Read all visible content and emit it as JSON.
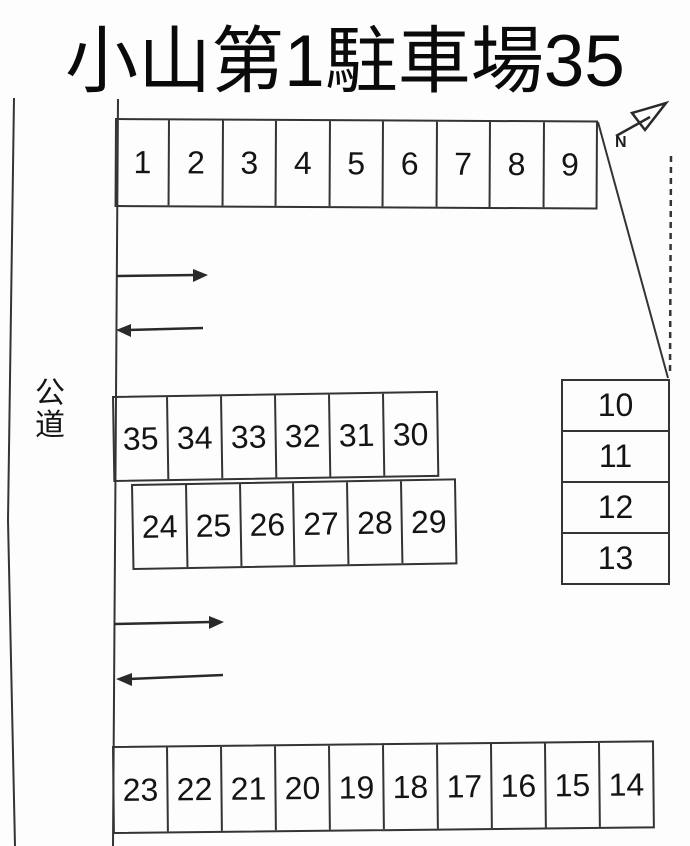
{
  "title": "小山第1駐車場35",
  "road_label": "公道",
  "compass": {
    "label": "N"
  },
  "spaces": {
    "top": [
      "1",
      "2",
      "3",
      "4",
      "5",
      "6",
      "7",
      "8",
      "9"
    ],
    "right_column": [
      "10",
      "11",
      "12",
      "13"
    ],
    "middle_upper": [
      "35",
      "34",
      "33",
      "32",
      "31",
      "30"
    ],
    "middle_lower": [
      "24",
      "25",
      "26",
      "27",
      "28",
      "29"
    ],
    "bottom": [
      "23",
      "22",
      "21",
      "20",
      "19",
      "18",
      "17",
      "16",
      "15",
      "14"
    ]
  },
  "colors": {
    "line": "#343434",
    "text": "#141414",
    "background": "#fdfdfd"
  }
}
